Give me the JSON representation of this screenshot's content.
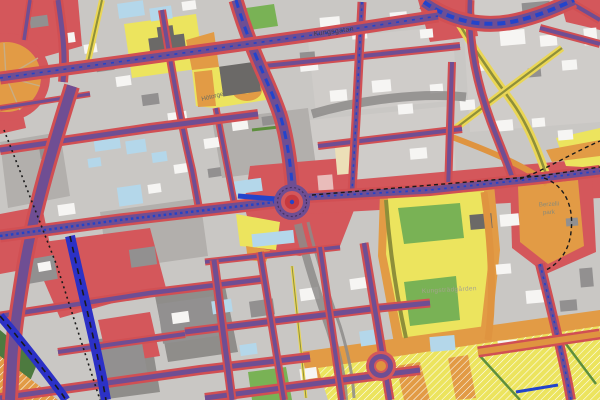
{
  "map": {
    "labels": {
      "kungsgatan": "Kungsgatan",
      "hotorget": "Hötorget",
      "berzelii_park_line1": "Berzelii",
      "berzelii_park_line2": "park",
      "kungstradgarden": "Kungsträdgården"
    },
    "palette": {
      "background_gray": "#c9c7c4",
      "block_gray": "#b2afac",
      "block_dark_gray": "#8f8d8a",
      "building_white": "#f6f5f3",
      "building_light_blue": "#b4d7ea",
      "building_dark_gray": "#6b6967",
      "road_red": "#d14f53",
      "road_core_purple": "#6f4e93",
      "road_orange": "#df9440",
      "road_yellow": "#ead655",
      "noise_zone_yellow": "#ece45e",
      "noise_zone_orange": "#e29b45",
      "park_green": "#79b255",
      "railway_blue": "#2c31c6",
      "tunnel_gray": "#8d8b89"
    }
  }
}
